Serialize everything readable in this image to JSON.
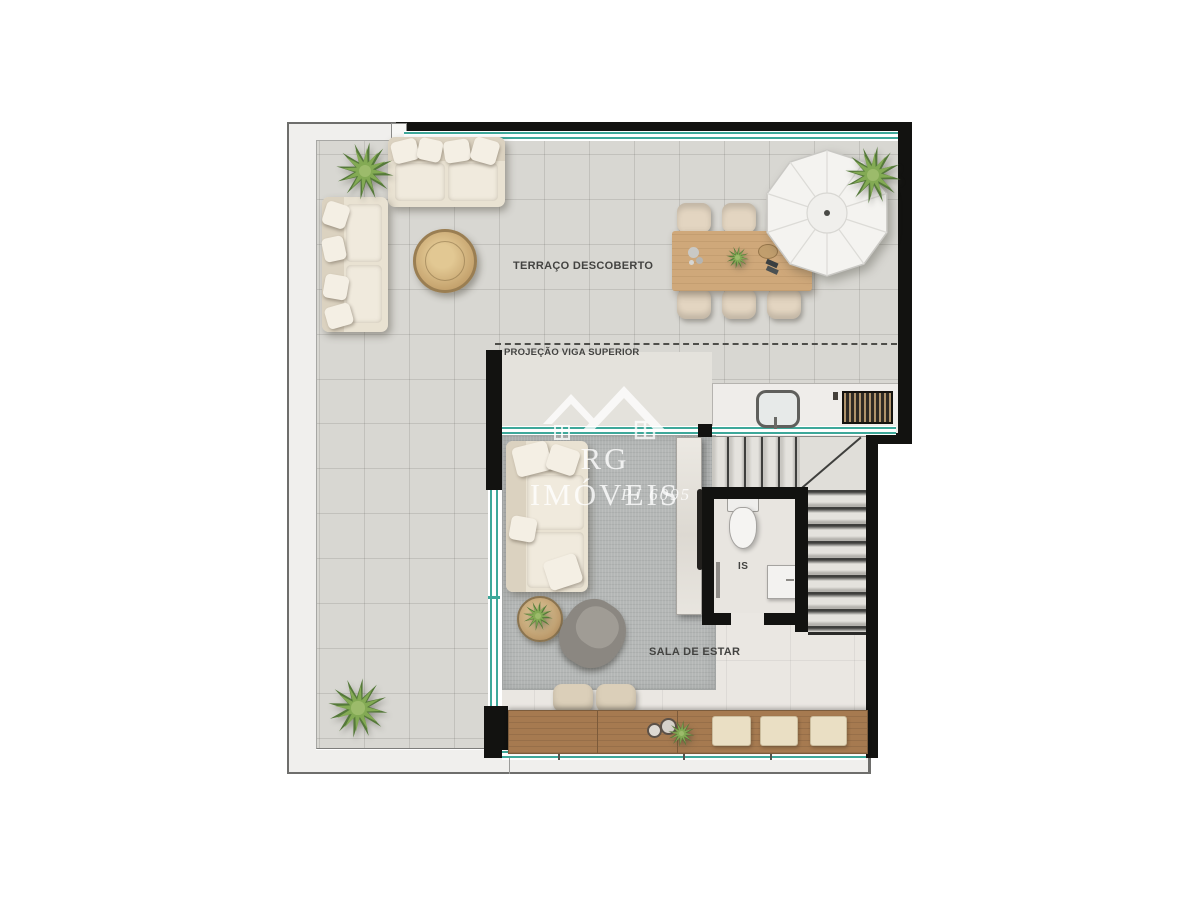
{
  "plan": {
    "labels": {
      "terrace": "TERRAÇO DESCOBERTO",
      "beam_projection": "PROJEÇÃO VIGA SUPERIOR",
      "living_room": "SALA DE ESTAR",
      "bathroom": "IS"
    },
    "watermark": {
      "brand": "RG IMÓVEIS",
      "registry": "PJ 6095"
    },
    "colors": {
      "glass_teal": "#3ea89a",
      "wall_black": "#121210",
      "terrace_tile": "#d8d7d2",
      "interior_floor": "#eae7e2",
      "rug_gray": "#b4b7b6",
      "bar_wood": "#a67a50",
      "table_wood": "#cfa87a",
      "sofa_cream": "#e9e2d2",
      "frame_band": "#f0efed"
    }
  }
}
